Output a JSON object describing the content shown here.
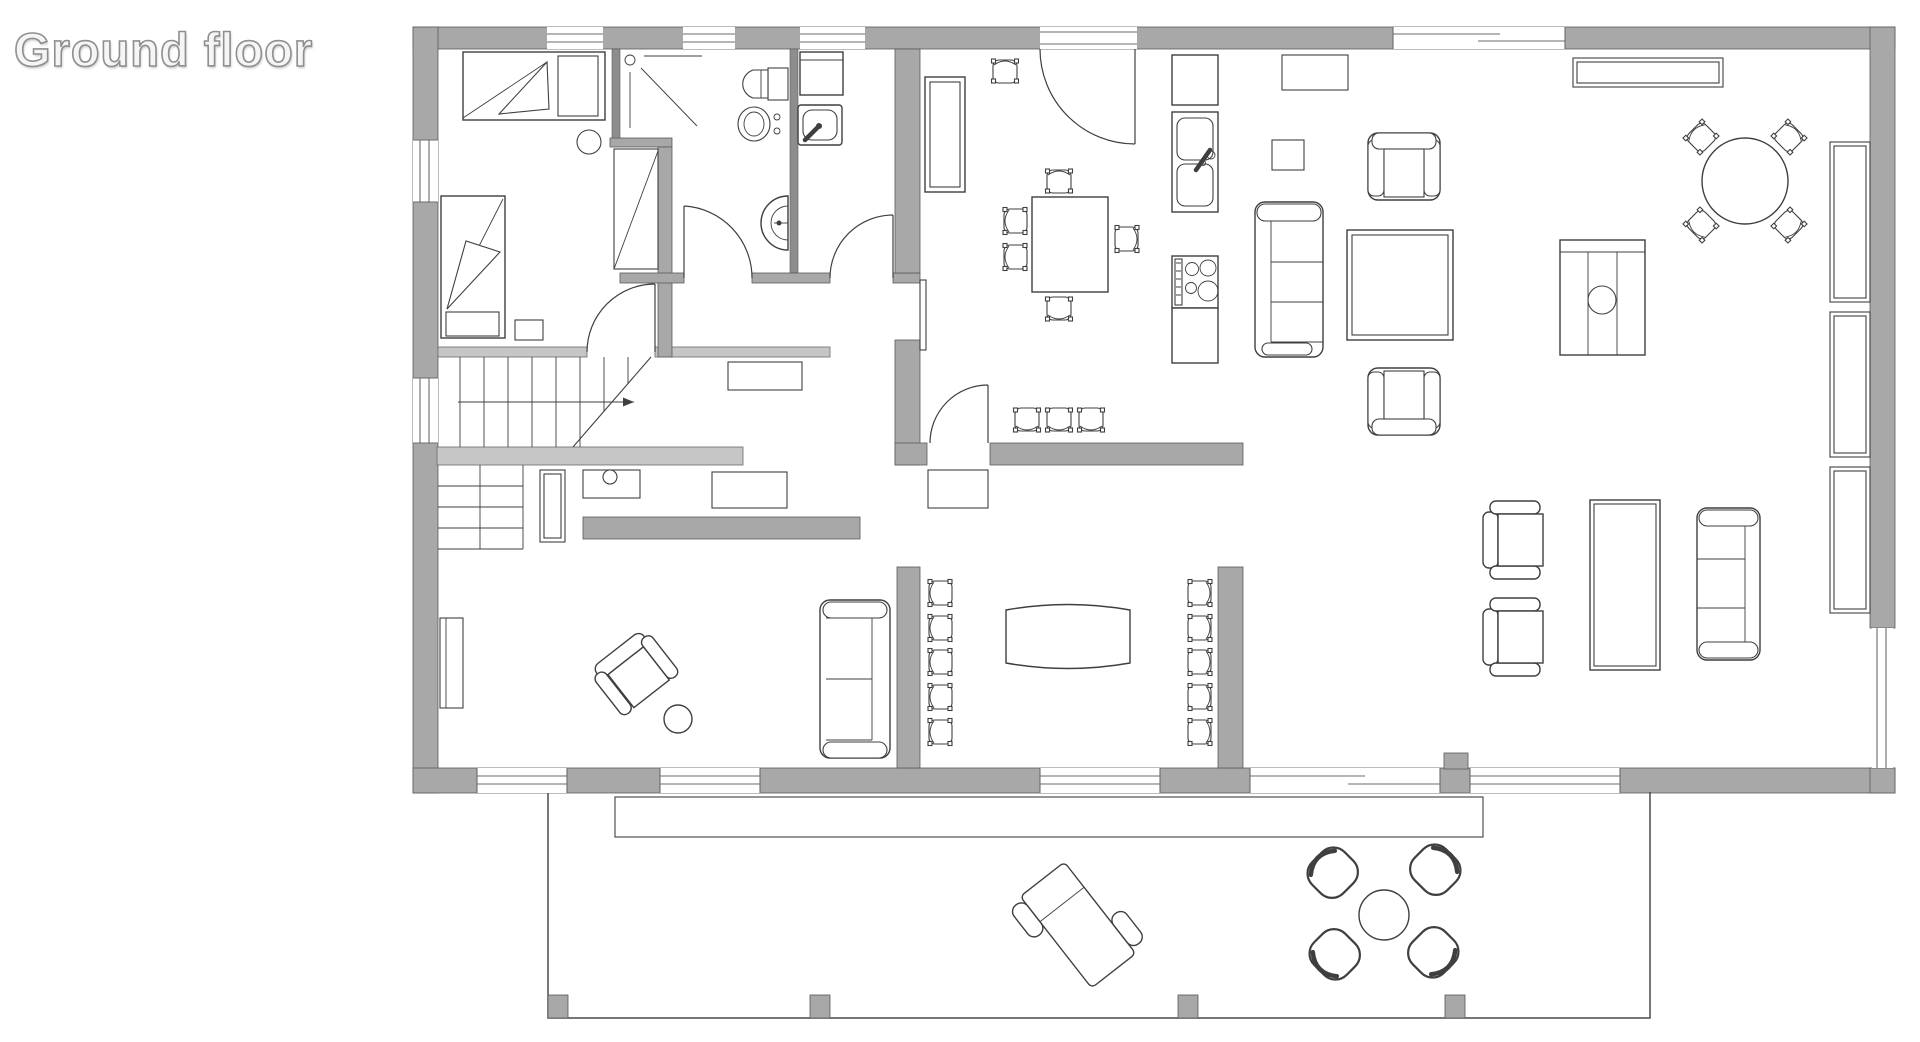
{
  "title": {
    "text": "Ground floor"
  },
  "colors": {
    "background": "#ffffff",
    "wall_fill": "#a8a8a8",
    "wall_light": "#c6c6c6",
    "wall_thin": "#8d8d8d",
    "line": "#3f3f3f",
    "window_line": "#6b6b6b",
    "title_color": "#8f8f8f"
  },
  "plan": {
    "floor_label": "Ground floor",
    "rooms": [
      {
        "name": "bedroom",
        "icons": [
          "single-bed-icon",
          "single-bed-icon",
          "wardrobe-icon",
          "nightstand-icon",
          "stool-icon"
        ]
      },
      {
        "name": "bathroom",
        "icons": [
          "shower-icon",
          "toilet-icon",
          "bidet-icon",
          "washbasin-icon"
        ]
      },
      {
        "name": "utility-room",
        "icons": [
          "washing-machine-icon",
          "shower-tray-icon"
        ]
      },
      {
        "name": "kitchen",
        "icons": [
          "tall-cabinet-icon",
          "dining-table-icon",
          "chair-icon",
          "sink-icon",
          "stove-icon"
        ]
      },
      {
        "name": "dining-room",
        "icons": [
          "long-table-icon",
          "chair-icon",
          "sideboard-icon"
        ]
      },
      {
        "name": "living-room",
        "icons": [
          "sofa-icon",
          "armchair-icon",
          "coffee-table-icon",
          "tv-sideboard-icon",
          "round-table-icon",
          "chair-icon",
          "shelf-icon",
          "cabinet-icon"
        ]
      },
      {
        "name": "study",
        "icons": [
          "desk-icon",
          "office-chair-icon",
          "side-table-icon",
          "lounge-chair-icon",
          "two-seat-sofa-icon",
          "bookcase-icon"
        ]
      },
      {
        "name": "staircase",
        "icons": [
          "stair-flight-icon",
          "direction-arrow-icon"
        ]
      },
      {
        "name": "terrace",
        "icons": [
          "sun-lounger-icon",
          "patio-table-icon",
          "patio-chair-icon",
          "pergola-post-icon"
        ]
      }
    ]
  }
}
